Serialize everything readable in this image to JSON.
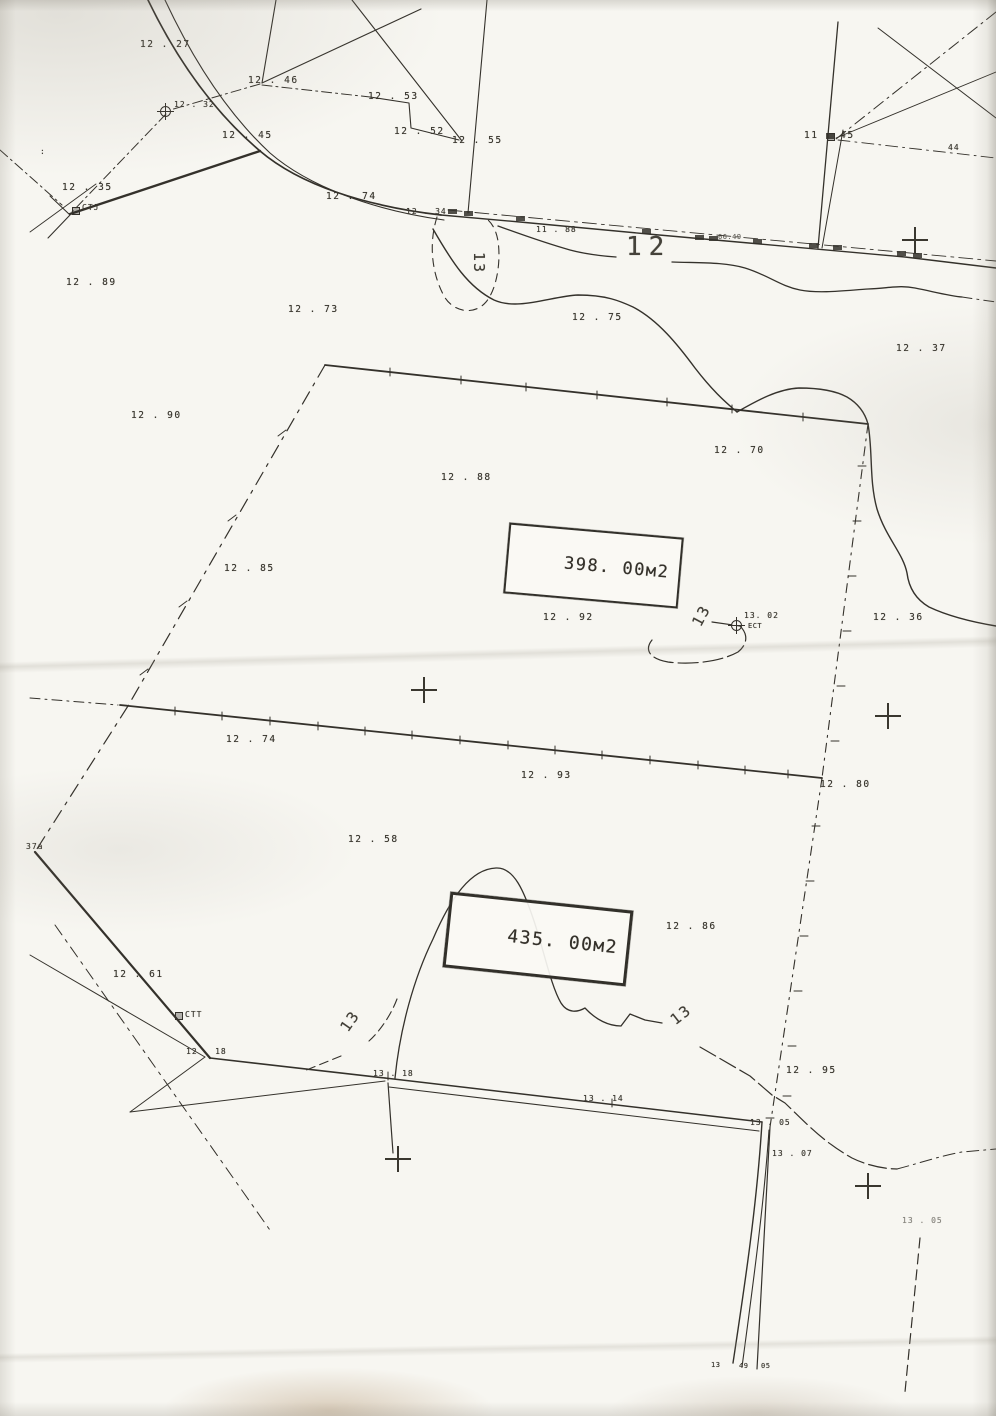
{
  "map": {
    "kind": "scanned cadastral survey plan",
    "ink_color": "#34312b",
    "paper_color": "#f7f6f1",
    "parcels": [
      {
        "area_label": "398. 00м2"
      },
      {
        "area_label": "435. 00м2"
      }
    ],
    "labels": [
      {
        "t": "12 . 27",
        "x": 140,
        "y": 40
      },
      {
        "t": "12 . 46",
        "x": 248,
        "y": 76
      },
      {
        "t": "12 . 53",
        "x": 368,
        "y": 92
      },
      {
        "t": "12 . 52",
        "x": 394,
        "y": 127
      },
      {
        "t": "12 . 55",
        "x": 452,
        "y": 136
      },
      {
        "t": "12 . 45",
        "x": 222,
        "y": 131
      },
      {
        "t": "12 . 32",
        "x": 174,
        "y": 101,
        "k": "small",
        "n": "survey-marker-text"
      },
      {
        "t": "12 . 35",
        "x": 62,
        "y": 183
      },
      {
        "t": "СТЈ",
        "x": 82,
        "y": 204,
        "k": "small",
        "n": "survey-marker-text"
      },
      {
        "t": ":",
        "x": 40,
        "y": 148,
        "k": "small"
      },
      {
        "t": "12 . 74",
        "x": 326,
        "y": 192
      },
      {
        "t": "12 . 34",
        "x": 406,
        "y": 208,
        "k": "small"
      },
      {
        "t": "11 . 88",
        "x": 536,
        "y": 226,
        "k": "small"
      },
      {
        "t": "66.49",
        "x": 718,
        "y": 234,
        "k": "tiny",
        "o": 0.75
      },
      {
        "t": "11 . 45",
        "x": 804,
        "y": 131
      },
      {
        "t": "44",
        "x": 948,
        "y": 144,
        "k": "small"
      },
      {
        "t": "12",
        "x": 626,
        "y": 234,
        "k": "contour-major",
        "n": "contour-label-12"
      },
      {
        "t": "13",
        "x": 486,
        "y": 252,
        "k": "contour",
        "r": 90,
        "n": "contour-label-13"
      },
      {
        "t": "12 . 89",
        "x": 66,
        "y": 278
      },
      {
        "t": "12 . 73",
        "x": 288,
        "y": 305
      },
      {
        "t": "12 . 75",
        "x": 572,
        "y": 313
      },
      {
        "t": "12 . 37",
        "x": 896,
        "y": 344
      },
      {
        "t": "12 . 90",
        "x": 131,
        "y": 411
      },
      {
        "t": "12 . 70",
        "x": 714,
        "y": 446
      },
      {
        "t": "12 . 88",
        "x": 441,
        "y": 473
      },
      {
        "t": "12 . 85",
        "x": 224,
        "y": 564
      },
      {
        "t": "12 . 92",
        "x": 543,
        "y": 613
      },
      {
        "t": "13",
        "x": 690,
        "y": 622,
        "k": "contour",
        "r": -62,
        "n": "contour-label-13"
      },
      {
        "t": "13. 02",
        "x": 744,
        "y": 612,
        "k": "small",
        "n": "survey-marker-text"
      },
      {
        "t": "ЕСТ",
        "x": 748,
        "y": 623,
        "k": "tiny",
        "n": "survey-marker-text"
      },
      {
        "t": "12 . 36",
        "x": 873,
        "y": 613
      },
      {
        "t": "12 . 74",
        "x": 226,
        "y": 735
      },
      {
        "t": "12 . 93",
        "x": 521,
        "y": 771
      },
      {
        "t": "12 . 80",
        "x": 820,
        "y": 780
      },
      {
        "t": "37a",
        "x": 26,
        "y": 843,
        "k": "small"
      },
      {
        "t": "12 . 58",
        "x": 348,
        "y": 835
      },
      {
        "t": "12 . 86",
        "x": 666,
        "y": 922
      },
      {
        "t": "12 . 61",
        "x": 113,
        "y": 970
      },
      {
        "t": "СТТ",
        "x": 185,
        "y": 1011,
        "k": "small",
        "n": "survey-marker-text"
      },
      {
        "t": "12 . 18",
        "x": 186,
        "y": 1048,
        "k": "small"
      },
      {
        "t": "13",
        "x": 338,
        "y": 1026,
        "k": "contour",
        "r": -55,
        "n": "contour-label-13"
      },
      {
        "t": "13 . 18",
        "x": 373,
        "y": 1070,
        "k": "small"
      },
      {
        "t": "13 . 14",
        "x": 583,
        "y": 1095,
        "k": "small"
      },
      {
        "t": "13",
        "x": 668,
        "y": 1016,
        "k": "contour",
        "r": -38,
        "n": "contour-label-13"
      },
      {
        "t": "12 . 95",
        "x": 786,
        "y": 1066
      },
      {
        "t": "13 . 05",
        "x": 750,
        "y": 1119,
        "k": "small"
      },
      {
        "t": "13 . 07",
        "x": 772,
        "y": 1150,
        "k": "small"
      },
      {
        "t": "13 . 05",
        "x": 902,
        "y": 1217,
        "k": "small",
        "o": 0.6
      },
      {
        "t": "13",
        "x": 711,
        "y": 1362,
        "k": "tiny"
      },
      {
        "t": "49",
        "x": 739,
        "y": 1363,
        "k": "tiny"
      },
      {
        "t": "05",
        "x": 761,
        "y": 1363,
        "k": "tiny"
      }
    ],
    "crosses": [
      {
        "x": 915,
        "y": 240
      },
      {
        "x": 424,
        "y": 690
      },
      {
        "x": 888,
        "y": 716
      },
      {
        "x": 398,
        "y": 1159
      },
      {
        "x": 868,
        "y": 1186
      }
    ],
    "markers": [
      {
        "type": "circle-cross",
        "x": 166,
        "y": 112,
        "n": "benchmark-marker"
      },
      {
        "type": "circle-cross",
        "x": 737,
        "y": 626,
        "n": "benchmark-marker"
      },
      {
        "type": "square",
        "x": 76,
        "y": 211,
        "n": "post-marker"
      },
      {
        "type": "square",
        "x": 179,
        "y": 1016,
        "n": "post-marker"
      },
      {
        "type": "square",
        "x": 831,
        "y": 137,
        "n": "post-marker"
      }
    ]
  }
}
